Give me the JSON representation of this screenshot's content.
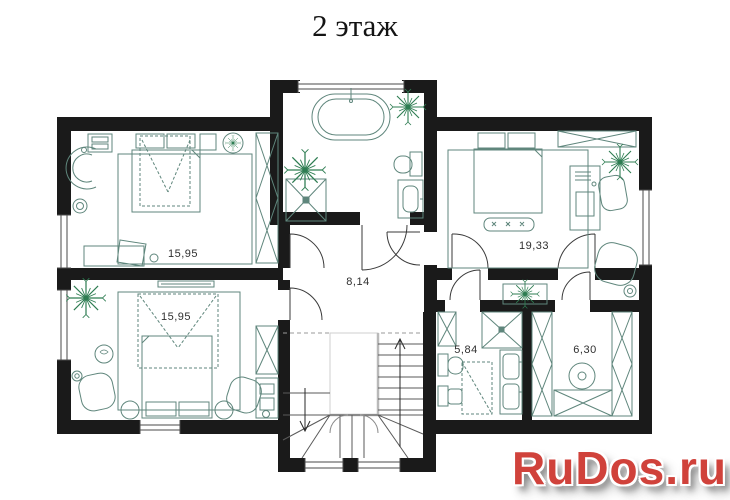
{
  "title": "2 этаж",
  "watermark": "RuDos.ru",
  "rooms": [
    {
      "id": "bedroom-upper-left",
      "area": "15,95"
    },
    {
      "id": "bedroom-lower-left",
      "area": "15,95"
    },
    {
      "id": "hall",
      "area": "8,14"
    },
    {
      "id": "bedroom-right",
      "area": "19,33"
    },
    {
      "id": "bathroom-small",
      "area": "5,84"
    },
    {
      "id": "laundry",
      "area": "6,30"
    }
  ],
  "colors": {
    "wall": "#1a1a1a",
    "furniture": "#5f867c",
    "plant": "#2e7d52",
    "label": "#2f2f2f",
    "watermark": "#d0423b"
  }
}
